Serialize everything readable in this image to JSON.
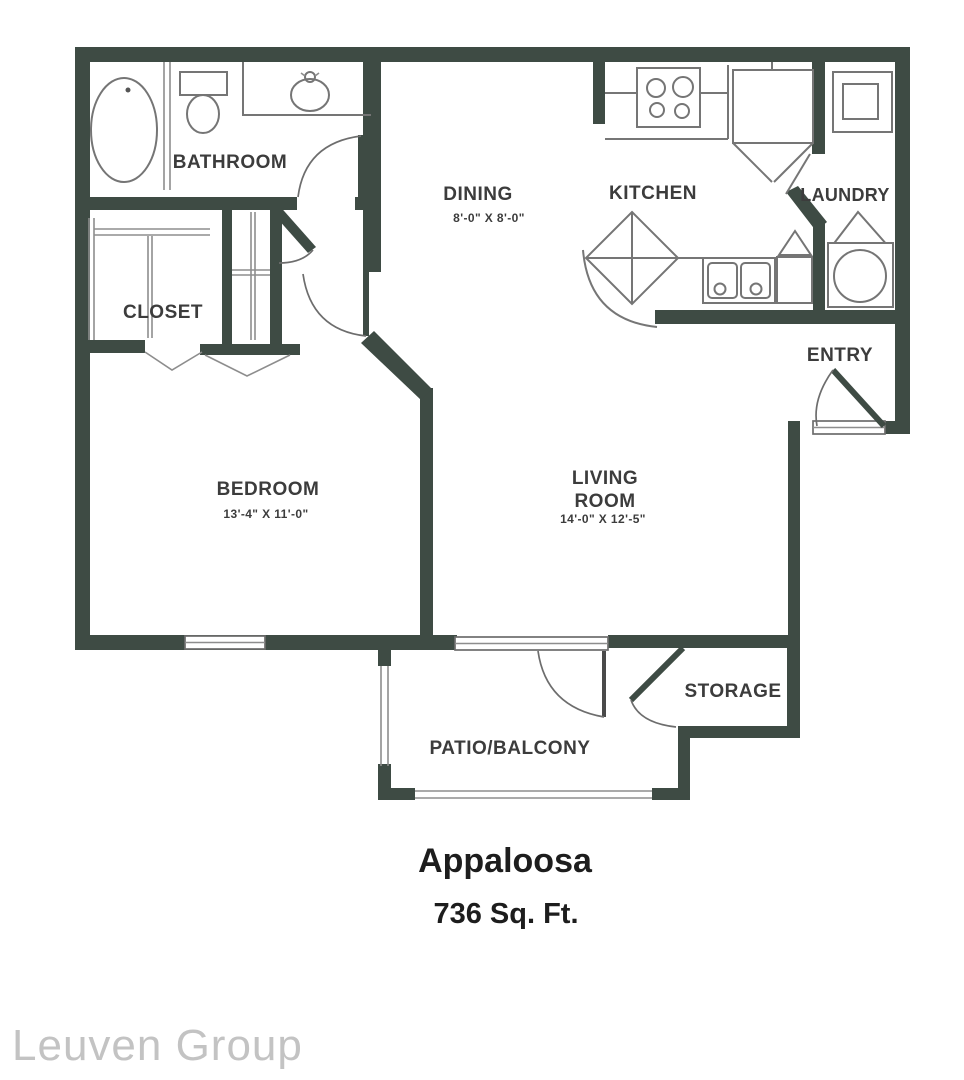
{
  "floor_plan": {
    "plan_name": "Appaloosa",
    "plan_area": "736 Sq. Ft.",
    "watermark": "Leuven Group",
    "rooms": {
      "bathroom": "BATHROOM",
      "closet": "CLOSET",
      "dining": "DINING",
      "dining_dims": "8'-0\" X 8'-0\"",
      "kitchen": "KITCHEN",
      "laundry": "LAUNDRY",
      "entry": "ENTRY",
      "bedroom": "BEDROOM",
      "bedroom_dims": "13'-4\" X 11'-0\"",
      "living_line1": "LIVING",
      "living_line2": "ROOM",
      "living_dims": "14'-0\" X 12'-5\"",
      "storage": "STORAGE",
      "patio": "PATIO/BALCONY"
    },
    "colors": {
      "wall": "#3e4b44",
      "fixture_line": "#757575",
      "label_text": "#3c3c3c",
      "watermark_text": "#c3c3c3"
    }
  }
}
